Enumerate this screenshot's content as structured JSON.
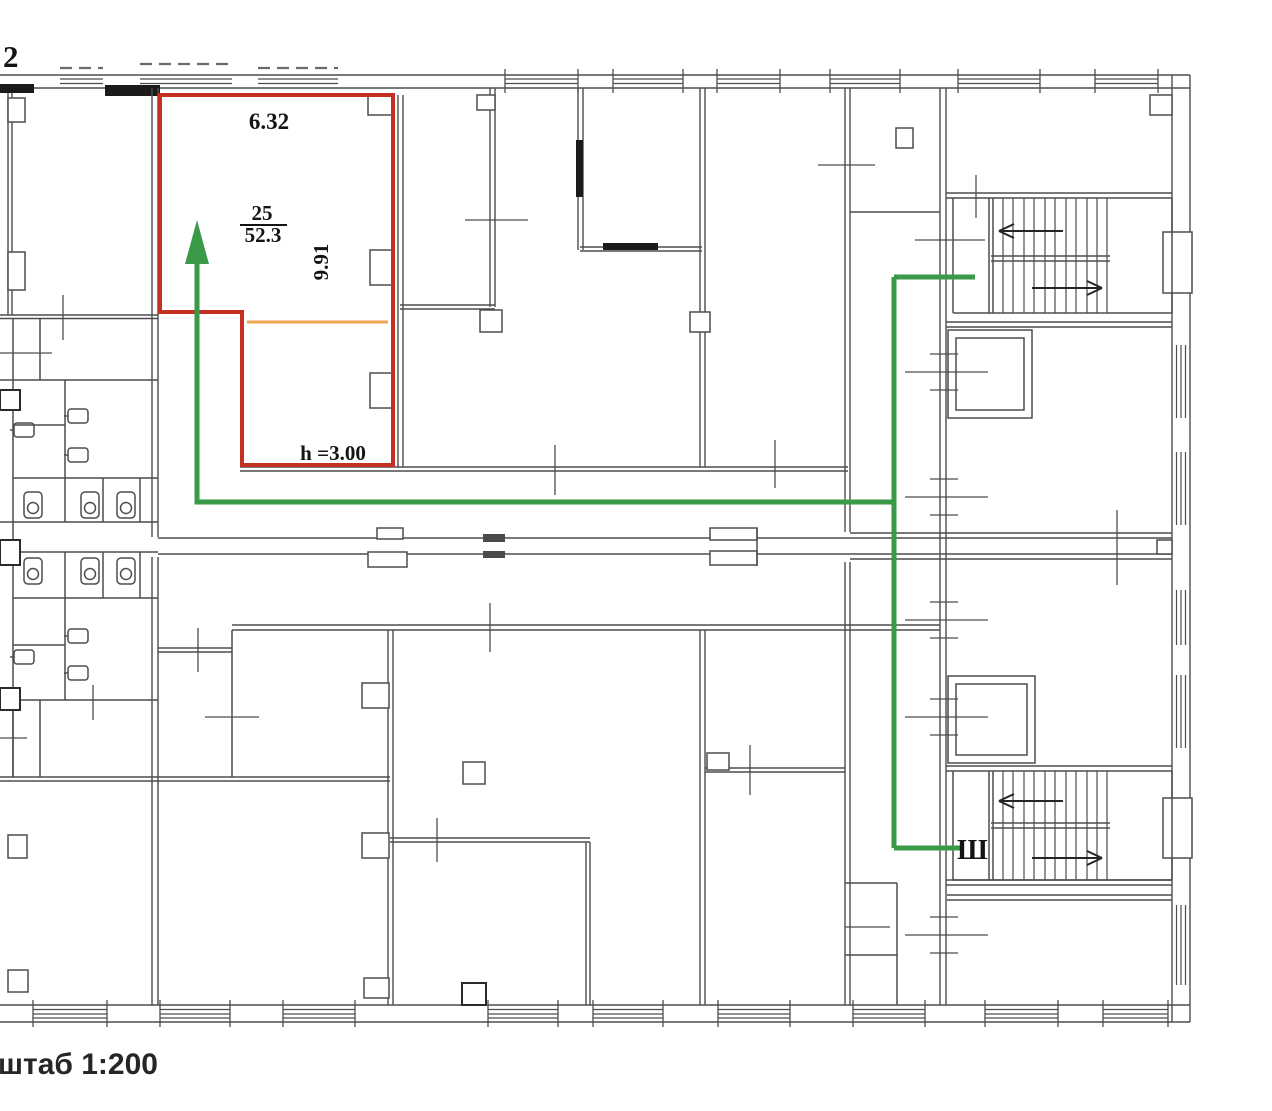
{
  "floor_plan": {
    "floor_label": "2",
    "scale_label": "штаб 1:200",
    "highlighted_room": {
      "number": "25",
      "area": "52.3",
      "width": "6.32",
      "depth": "9.91",
      "ceiling_height": "h =3.00"
    },
    "staircase_label": "Ш"
  },
  "colors": {
    "room_highlight": "#c53022",
    "route": "#3a9a47",
    "section_divider": "#efa652",
    "walls": "#4d4d4d",
    "text": "#141414"
  }
}
